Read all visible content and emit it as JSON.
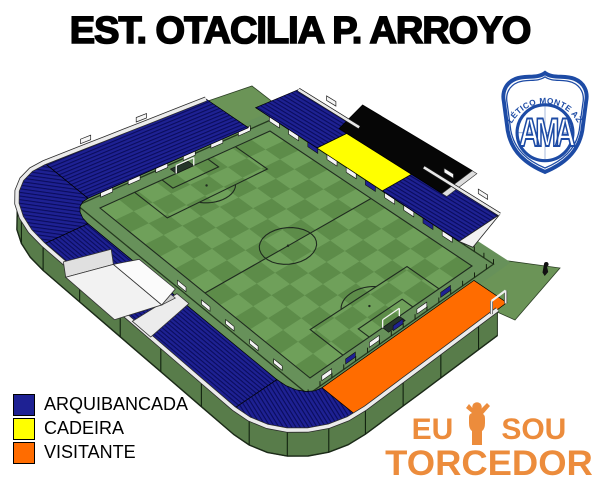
{
  "title": "EST. OTACILIA P. ARROYO",
  "legend": {
    "items": [
      {
        "id": "arquibancada",
        "label": "ARQUIBANCADA",
        "color": "#1e2193"
      },
      {
        "id": "cadeira",
        "label": "CADEIRA",
        "color": "#ffff00"
      },
      {
        "id": "visitante",
        "label": "VISITANTE",
        "color": "#ff6c00"
      }
    ]
  },
  "badge": {
    "club_name": "ATLÉTICO MONTE AZUL",
    "monogram": "AMA",
    "color": "#1d4ba5"
  },
  "watermark": {
    "word1": "EU",
    "word2": "SOU",
    "word3": "TORCEDOR",
    "color": "#ec8c3c"
  },
  "colors": {
    "navy": "#1e2193",
    "navy_line": "#0a0c5c",
    "cadeira_yellow": "#ffff00",
    "visitante_orange": "#ff6c00",
    "roof_black": "#060606",
    "grass_light": "#6fa05a",
    "grass_dark": "#5d8c49",
    "apron_green": "#67915a",
    "outer_green": "#6b9457",
    "wall_green": "#587c4a"
  },
  "stadium": {
    "calibration": {
      "W": [
        100,
        208
      ],
      "S": [
        310,
        378
      ],
      "N": [
        270,
        131
      ],
      "E": [
        472,
        266
      ]
    },
    "sections": [
      {
        "id": "arquibancada-nw"
      },
      {
        "id": "arquibancada-curva-oeste"
      },
      {
        "id": "arquibancada-sw"
      },
      {
        "id": "arquibancada-curva-sul"
      },
      {
        "id": "arquibancada-ne-esquerda"
      },
      {
        "id": "arquibancada-ne-direita"
      },
      {
        "id": "cadeira"
      },
      {
        "id": "visitante"
      }
    ]
  }
}
